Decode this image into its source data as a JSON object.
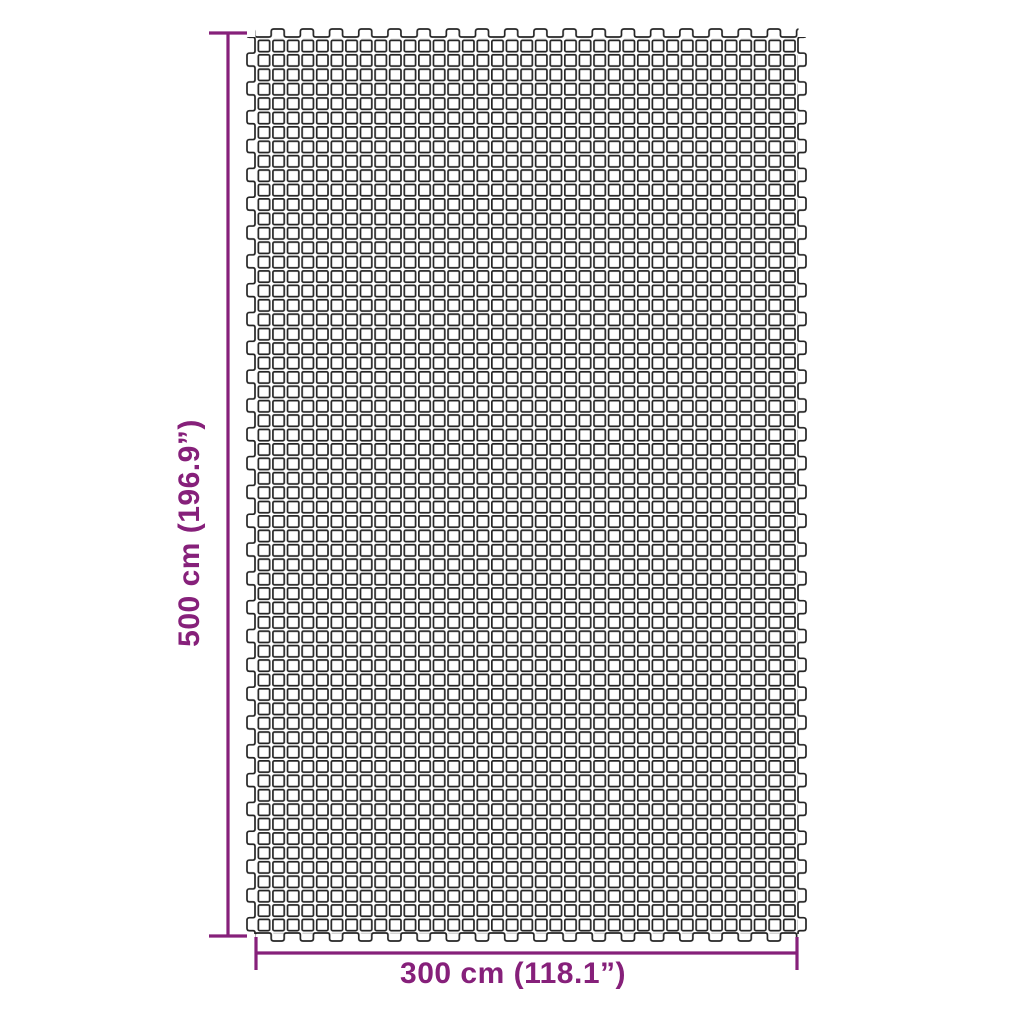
{
  "page": {
    "background_color": "#ffffff"
  },
  "diagram": {
    "type": "product-dimension-diagram",
    "subject": "mesh ground mat (camping floor mat)",
    "accent_color": "#86207a",
    "mesh_stroke_color": "#252525",
    "mesh_fill_color": "#ffffff",
    "mesh_columns": 37,
    "mesh_rows": 62,
    "height_dimension": {
      "label": "500 cm (196.9”)"
    },
    "width_dimension": {
      "label": "300 cm (118.1”)"
    }
  }
}
